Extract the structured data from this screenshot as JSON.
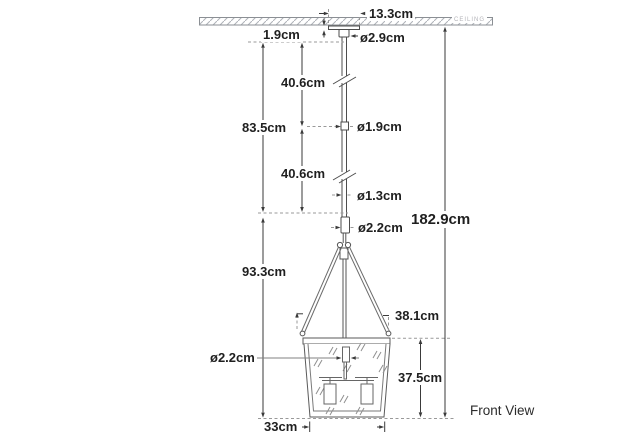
{
  "view_label": "Front View",
  "ceiling_label": "CEILING",
  "dimensions": {
    "canopy_width": "13.3cm",
    "canopy_height": "1.9cm",
    "canopy_stem_diameter": "ø2.9cm",
    "upper_rod_length": "40.6cm",
    "rod_overall_length": "83.5cm",
    "rod_diameter": "ø1.9cm",
    "lower_rod_length": "40.6cm",
    "cord_diameter": "ø1.3cm",
    "stem_diameter": "ø2.2cm",
    "overall_height": "182.9cm",
    "fixture_drop": "93.3cm",
    "yoke_width": "38.1cm",
    "shade_height": "37.5cm",
    "inner_stem_diameter": "ø2.2cm",
    "shade_bottom_width": "33cm"
  }
}
